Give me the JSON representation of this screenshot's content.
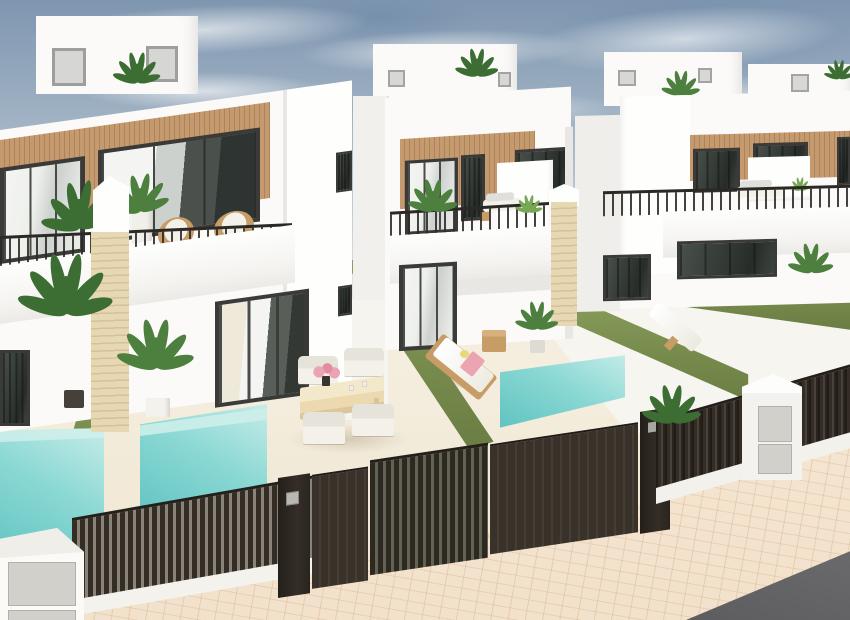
{
  "scene": {
    "type": "3d-architectural-render",
    "description": "Row of modern white two-storey townhouses with wood-slat cladding, glass balconies, private turquoise plunge pools, artificial-grass walls, dark slatted fences and gates, viewed from above street level",
    "palette": {
      "sky-top": "#7f96b0",
      "sky-mid": "#a9bac9",
      "sky-low": "#dfe3e5",
      "cloud": "#eef1f3",
      "wall": "#fbfaf8",
      "wall-bright": "#fefefd",
      "wall-side": "#f1f0ec",
      "wall-shade": "#e8e7e3",
      "wood": "#c59a6e",
      "wood-line": "#ad835a",
      "frame": "#3a3a38",
      "glass-a": "#eef0ec",
      "glass-b": "#cdd1cd",
      "glass-dark": "#343a36",
      "curtain": "#f4f5f2",
      "rail": "#2b2925",
      "grass": "#778b4d",
      "grass-light": "#8ba05e",
      "grass-dark": "#697d43",
      "pool-a": "#c6ece8",
      "pool-b": "#8bd8d4",
      "pool-c": "#5fc3c0",
      "fence": "#342d26",
      "fence-hi": "#4a4138",
      "gap": "#8a8478",
      "gap-green": "#5f6350",
      "stone": "#e7d8b4",
      "stone-line": "#d6c198",
      "terrace": "#f3ecdc",
      "pave": "#f2e1cb",
      "pave-line": "#cfa77e",
      "road": "#5d5d5f",
      "plant-dark": "#3c6e34",
      "plant-mid": "#4d7f3e",
      "plant-light": "#79a855",
      "rattan": "#c79c66",
      "cushion": "#f3f1ea",
      "pillow": "#dfe0dc",
      "pink": "#eba4b2",
      "sun": "#e8d878",
      "table-wood": "#ecd9b0",
      "panel": "#d2d0cb"
    },
    "objects": [
      "sky with wispy clouds",
      "four white townhouses receding to the right",
      "rooftop stair boxes with access doors",
      "wood slat cladding on upper floors",
      "dark aluminium framed windows and sliding glass doors",
      "black metal balcony railings",
      "rattan chairs on left balcony",
      "white outdoor sofas on balconies",
      "sandstone brick pillars",
      "artificial grass boundary walls and lawns",
      "three turquoise plunge pools",
      "cream tiled patios",
      "outdoor dining table with four cream chairs and pink flowers",
      "wooden sun lounger with pink towel and side table",
      "white sun lounger",
      "potted palms and tropical plants",
      "dark brown vertical-slat fences",
      "dark sliding entrance gates with keypad",
      "white utility pillars with meter panels",
      "beige brick-paved sidewalk",
      "asphalt road"
    ]
  }
}
